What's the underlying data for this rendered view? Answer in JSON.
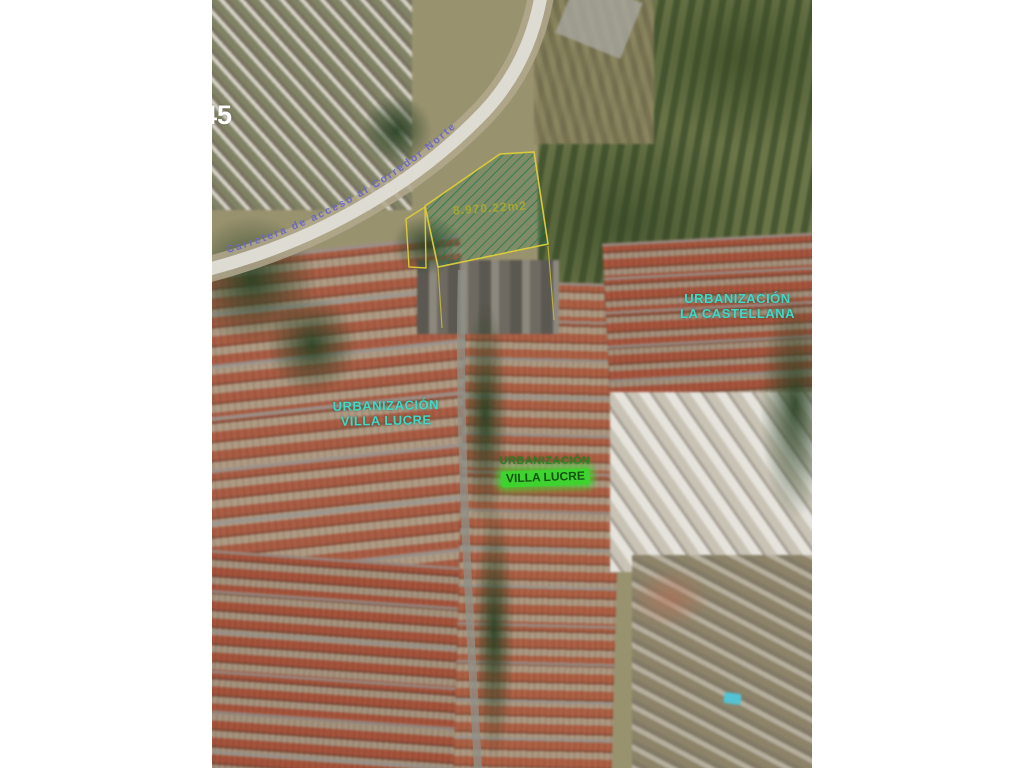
{
  "map": {
    "watermark": "45",
    "road": {
      "label": "Carretera  de  acceso  al  Corredor  Norte",
      "label_color": "#6a6ac0"
    },
    "parcel": {
      "area_label": "8.970.22m2",
      "outline_color": "#d9c93d",
      "hatch_color": "#1f7a4d",
      "area_label_color": "#a8a832"
    },
    "labels": [
      {
        "id": "urbanizacion-la-castellana",
        "line1": "URBANIZACIÓN",
        "line2": "LA CASTELLANA",
        "color": "#3fd9c6"
      },
      {
        "id": "urbanizacion-villa-lucre",
        "line1": "URBANIZACIÓN",
        "line2": "VILLA LUCRE",
        "color": "#3fd9c6"
      },
      {
        "id": "urbanizacion-center",
        "line1": "URBANIZACIÓN",
        "line2": "VILLA LUCRE",
        "color": "#2a7d1f",
        "highlight_color": "#3ed32e"
      }
    ],
    "features": {
      "pool_color": "#49c8dc"
    }
  }
}
